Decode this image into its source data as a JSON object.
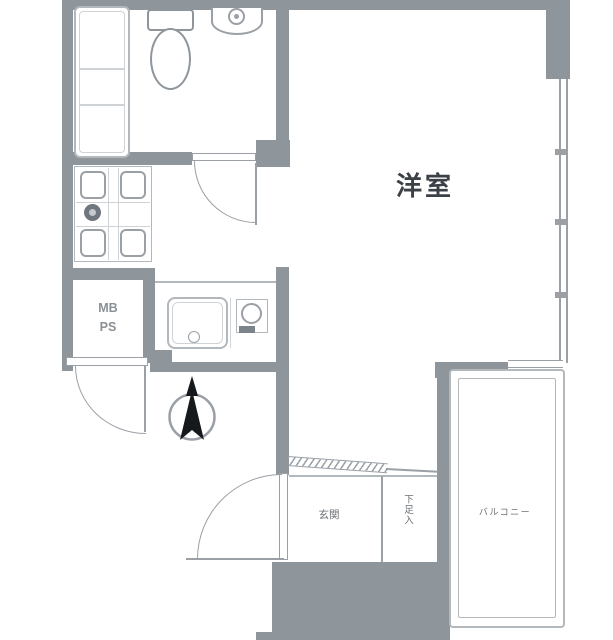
{
  "plan": {
    "labels": {
      "main_room": "洋室",
      "meter_box": "MB",
      "pipe_space": "PS",
      "entrance": "玄関",
      "shoe_cabinet": "下足入",
      "balcony": "バルコニー"
    },
    "colors": {
      "wall": "#8e959b",
      "line": "#9aa0a6",
      "fixture": "#b3b8bd",
      "light": "#d0d3d6",
      "text-dark": "#3c4147",
      "text-gray": "#6b7176",
      "text-mid": "#8a9096",
      "arrow": "#16191c"
    }
  }
}
